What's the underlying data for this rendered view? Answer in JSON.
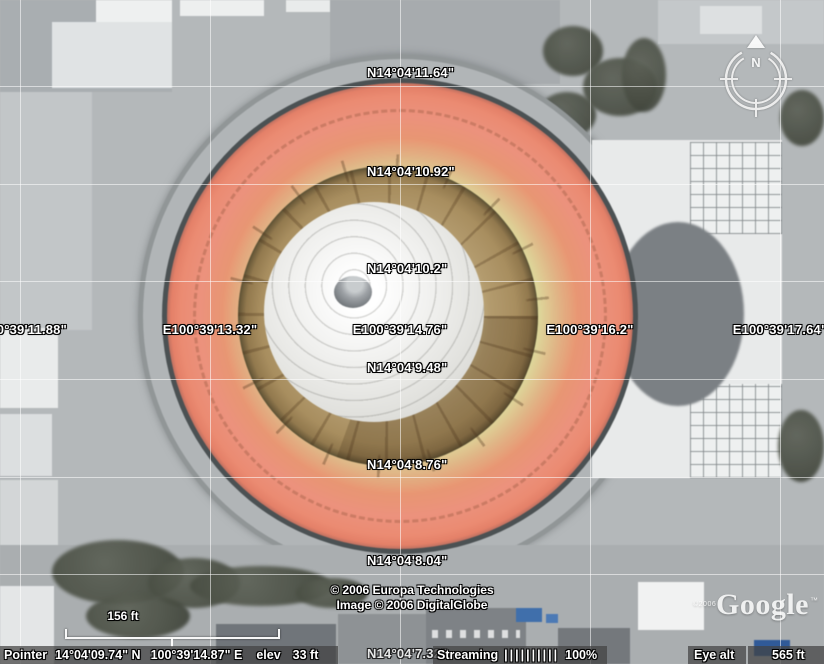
{
  "grid": {
    "latitudes": [
      "N14°04'11.64\"",
      "N14°04'10.92\"",
      "N14°04'10.2\"",
      "N14°04'9.48\"",
      "N14°04'8.76\"",
      "N14°04'8.04\"",
      "N14°04'7.32\""
    ],
    "longitudes": [
      "E100°39'11.88\"",
      "E100°39'13.32\"",
      "E100°39'14.76\"",
      "E100°39'16.2\"",
      "E100°39'17.64\""
    ]
  },
  "attribution": {
    "line1": "© 2006 Europa Technologies",
    "line2": "Image © 2006 DigitalGlobe"
  },
  "scale": {
    "label": "156 ft"
  },
  "compass": {
    "north_label": "N"
  },
  "logo": {
    "copyright": "©2006",
    "text": "Google",
    "tm": "™"
  },
  "status_bar": {
    "pointer": {
      "label": "Pointer",
      "latitude": "14°04'09.74\" N",
      "longitude": "100°39'14.87\" E",
      "elev_label": "elev",
      "elev_value": "33 ft"
    },
    "streaming": {
      "label": "Streaming",
      "bars": "||||||||||",
      "percent": "100%"
    },
    "eye_alt": {
      "label": "Eye alt",
      "value": "565 ft"
    }
  },
  "colors": {
    "stadium_roof_red": "#ef8a70",
    "stadium_ring_tan": "#a98e5c",
    "grid_line": "rgba(255,255,255,0.55)",
    "status_chip": "rgba(66,66,66,0.72)"
  }
}
